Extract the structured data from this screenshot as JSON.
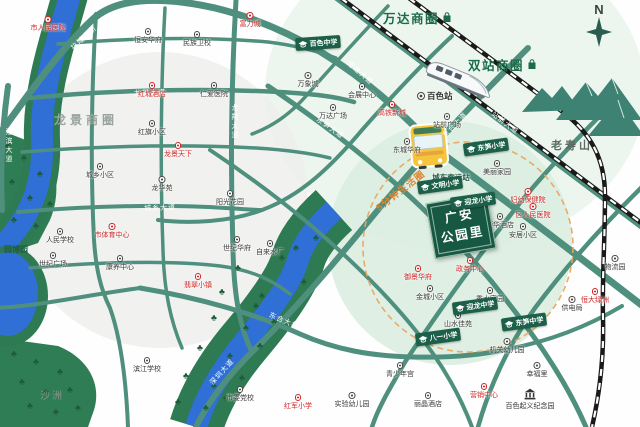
{
  "compass": {
    "label": "N"
  },
  "business_circles": [
    {
      "label": "万达商圈"
    },
    {
      "label": "双站商圈"
    },
    {
      "label": "龙景商圈"
    }
  ],
  "mountain": {
    "label": "老寿山"
  },
  "areas": {
    "island_label": "沙洲",
    "expo_label": "园博园"
  },
  "transit": {
    "rail_station_label": "百色站",
    "bus_station_label": "城东客运站",
    "life_circle_label": "5分钟生活圈"
  },
  "project": {
    "line1": "广安",
    "line2": "公园里"
  },
  "landmark": {
    "label": "百色起义纪念园"
  },
  "pois": [
    {
      "label": "市人民医院",
      "x": 48,
      "y": 16,
      "type": "red"
    },
    {
      "label": "富力城",
      "x": 250,
      "y": 12,
      "type": "red"
    },
    {
      "label": "红城酒店",
      "x": 152,
      "y": 82,
      "type": "red"
    },
    {
      "label": "龙景天下",
      "x": 178,
      "y": 142,
      "type": "red"
    },
    {
      "label": "市体育中心",
      "x": 112,
      "y": 223,
      "type": "red"
    },
    {
      "label": "翡翠小镇",
      "x": 198,
      "y": 273,
      "type": "red"
    },
    {
      "label": "红军小学",
      "x": 298,
      "y": 394,
      "type": "red"
    },
    {
      "label": "御景华府",
      "x": 418,
      "y": 265,
      "type": "red"
    },
    {
      "label": "妇幼保健院",
      "x": 528,
      "y": 188,
      "type": "red"
    },
    {
      "label": "区人民医院",
      "x": 533,
      "y": 203,
      "type": "red"
    },
    {
      "label": "营销中心",
      "x": 484,
      "y": 383,
      "type": "red"
    },
    {
      "label": "恒大绿洲",
      "x": 595,
      "y": 288,
      "type": "red"
    },
    {
      "label": "政务中心",
      "x": 470,
      "y": 257,
      "type": "red"
    },
    {
      "label": "高铁新城",
      "x": 392,
      "y": 101,
      "type": "red"
    },
    {
      "label": "恒安华府",
      "x": 148,
      "y": 28,
      "type": "black"
    },
    {
      "label": "民族卫校",
      "x": 197,
      "y": 31,
      "type": "black"
    },
    {
      "label": "仁爱医院",
      "x": 214,
      "y": 82,
      "type": "black"
    },
    {
      "label": "红旗小区",
      "x": 152,
      "y": 120,
      "type": "black"
    },
    {
      "label": "城乡小区",
      "x": 100,
      "y": 163,
      "type": "black"
    },
    {
      "label": "龙华苑",
      "x": 162,
      "y": 176,
      "type": "black"
    },
    {
      "label": "阳光花园",
      "x": 230,
      "y": 190,
      "type": "black"
    },
    {
      "label": "人民学校",
      "x": 60,
      "y": 228,
      "type": "black"
    },
    {
      "label": "世纪广场",
      "x": 53,
      "y": 252,
      "type": "black"
    },
    {
      "label": "康养中心",
      "x": 120,
      "y": 255,
      "type": "black"
    },
    {
      "label": "世纪华府",
      "x": 237,
      "y": 236,
      "type": "black"
    },
    {
      "label": "自来水厂",
      "x": 270,
      "y": 240,
      "type": "black"
    },
    {
      "label": "万象城",
      "x": 308,
      "y": 72,
      "type": "black"
    },
    {
      "label": "万达广场",
      "x": 333,
      "y": 104,
      "type": "black"
    },
    {
      "label": "会展中心",
      "x": 362,
      "y": 83,
      "type": "black"
    },
    {
      "label": "站前广场",
      "x": 447,
      "y": 113,
      "type": "black"
    },
    {
      "label": "东城华府",
      "x": 407,
      "y": 138,
      "type": "black"
    },
    {
      "label": "美丽家园",
      "x": 497,
      "y": 160,
      "type": "black"
    },
    {
      "label": "荣华酒店",
      "x": 500,
      "y": 213,
      "type": "black"
    },
    {
      "label": "安居小区",
      "x": 523,
      "y": 223,
      "type": "black"
    },
    {
      "label": "金城小区",
      "x": 430,
      "y": 285,
      "type": "black"
    },
    {
      "label": "秀水家园",
      "x": 490,
      "y": 287,
      "type": "black"
    },
    {
      "label": "山水佳苑",
      "x": 458,
      "y": 312,
      "type": "black"
    },
    {
      "label": "机关幼儿园",
      "x": 507,
      "y": 338,
      "type": "black"
    },
    {
      "label": "青少年宫",
      "x": 400,
      "y": 362,
      "type": "black"
    },
    {
      "label": "市委党校",
      "x": 240,
      "y": 386,
      "type": "black"
    },
    {
      "label": "实验幼儿园",
      "x": 352,
      "y": 392,
      "type": "black"
    },
    {
      "label": "滨江学校",
      "x": 147,
      "y": 357,
      "type": "black"
    },
    {
      "label": "物流园",
      "x": 615,
      "y": 255,
      "type": "black"
    },
    {
      "label": "幸福里",
      "x": 537,
      "y": 362,
      "type": "black"
    },
    {
      "label": "供电局",
      "x": 572,
      "y": 296,
      "type": "black"
    },
    {
      "label": "丽晶酒店",
      "x": 428,
      "y": 392,
      "type": "black"
    }
  ],
  "schools": [
    {
      "label": "百色中学",
      "x": 318,
      "y": 43,
      "rot": -4
    },
    {
      "label": "东笋小学",
      "x": 486,
      "y": 147,
      "rot": -8
    },
    {
      "label": "文明小学",
      "x": 440,
      "y": 185,
      "rot": -8
    },
    {
      "label": "迎龙小学",
      "x": 473,
      "y": 201,
      "rot": -8
    },
    {
      "label": "迎龙中学",
      "x": 475,
      "y": 306,
      "rot": -8
    },
    {
      "label": "东笋中学",
      "x": 524,
      "y": 322,
      "rot": -8
    },
    {
      "label": "八一小学",
      "x": 438,
      "y": 337,
      "rot": -8
    }
  ],
  "road_labels": [
    {
      "label": "拉域大桥",
      "x": 84,
      "y": 38,
      "rot": -42
    },
    {
      "label": "迎龙大道",
      "x": 360,
      "y": 73,
      "rot": 41
    },
    {
      "label": "龙景大道",
      "x": 150,
      "y": 93,
      "rot": -2
    },
    {
      "label": "城乡大道",
      "x": 160,
      "y": 208,
      "rot": -2
    },
    {
      "label": "站前大道",
      "x": 505,
      "y": 123,
      "rot": 37
    },
    {
      "label": "东合大道",
      "x": 455,
      "y": 125,
      "rot": -46
    },
    {
      "label": "东笋大道",
      "x": 330,
      "y": 128,
      "rot": 35
    },
    {
      "label": "深圳大道",
      "x": 222,
      "y": 372,
      "rot": -48
    },
    {
      "label": "东合大桥",
      "x": 284,
      "y": 321,
      "rot": 23
    },
    {
      "label": "江滨大道",
      "x": 8,
      "y": 128,
      "vertical": true
    },
    {
      "label": "龙翔大道",
      "x": 234,
      "y": 104,
      "vertical": true
    }
  ],
  "trees": [
    [
      8,
      146
    ],
    [
      24,
      158
    ],
    [
      40,
      174
    ],
    [
      12,
      182
    ],
    [
      30,
      198
    ],
    [
      14,
      220
    ],
    [
      36,
      226
    ],
    [
      50,
      204
    ],
    [
      14,
      354
    ],
    [
      36,
      362
    ],
    [
      60,
      372
    ],
    [
      22,
      382
    ],
    [
      46,
      392
    ],
    [
      70,
      390
    ],
    [
      30,
      406
    ],
    [
      56,
      412
    ],
    [
      78,
      408
    ],
    [
      316,
      238
    ],
    [
      296,
      248
    ],
    [
      282,
      258
    ],
    [
      304,
      282
    ],
    [
      262,
      296
    ],
    [
      238,
      268
    ],
    [
      222,
      292
    ],
    [
      256,
      306
    ],
    [
      214,
      318
    ],
    [
      246,
      328
    ],
    [
      274,
      322
    ],
    [
      200,
      348
    ],
    [
      230,
      356
    ],
    [
      260,
      346
    ],
    [
      186,
      376
    ],
    [
      214,
      386
    ],
    [
      242,
      378
    ],
    [
      178,
      402
    ],
    [
      206,
      408
    ],
    [
      226,
      398
    ]
  ],
  "icons": {
    "tree": "♣",
    "train": "high-speed-train",
    "bus": "bus",
    "compass_star": "compass-star",
    "graduation_cap": "graduation-cap",
    "museum": "museum",
    "shopping_bag": "shopping-bag"
  },
  "colors": {
    "road": "#4f8f7d",
    "river": "#2f6fd6",
    "forest": "#2f7d54",
    "railway": "#1a1a1a",
    "circle_green": "#1b6b4b",
    "project_bg": "#175843",
    "life_circle_orange": "#e0852f",
    "poi_red": "#cf2727",
    "mountain": "#3d8273",
    "bus_yellow": "#f5c63b"
  }
}
